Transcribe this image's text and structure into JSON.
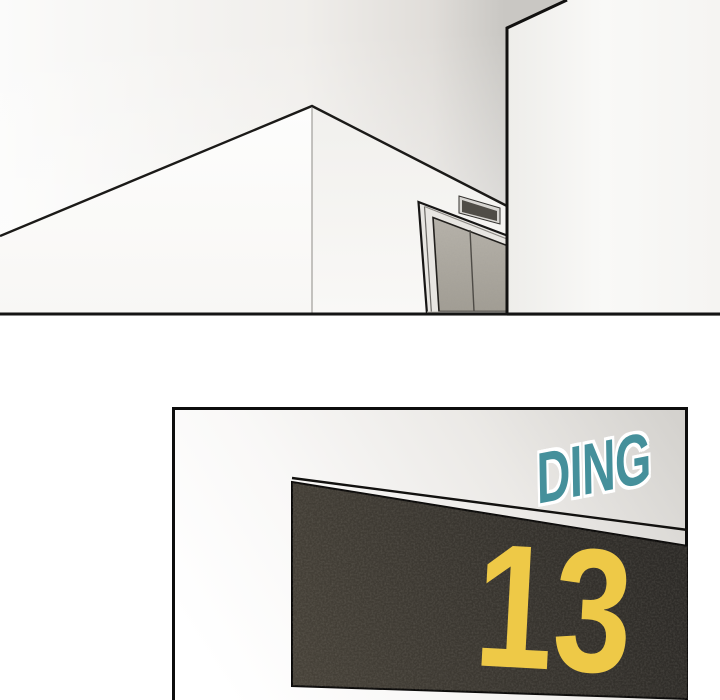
{
  "comic": {
    "sfx": {
      "text": "DING"
    },
    "floor_display": {
      "number": "13"
    }
  },
  "colors": {
    "sfx_teal": "#45909b",
    "sfx_outline": "#ffffff",
    "digit_yellow": "#eec947",
    "panel_dark": "#2b2926",
    "panel_light": "#474239",
    "ink": "#141312"
  }
}
